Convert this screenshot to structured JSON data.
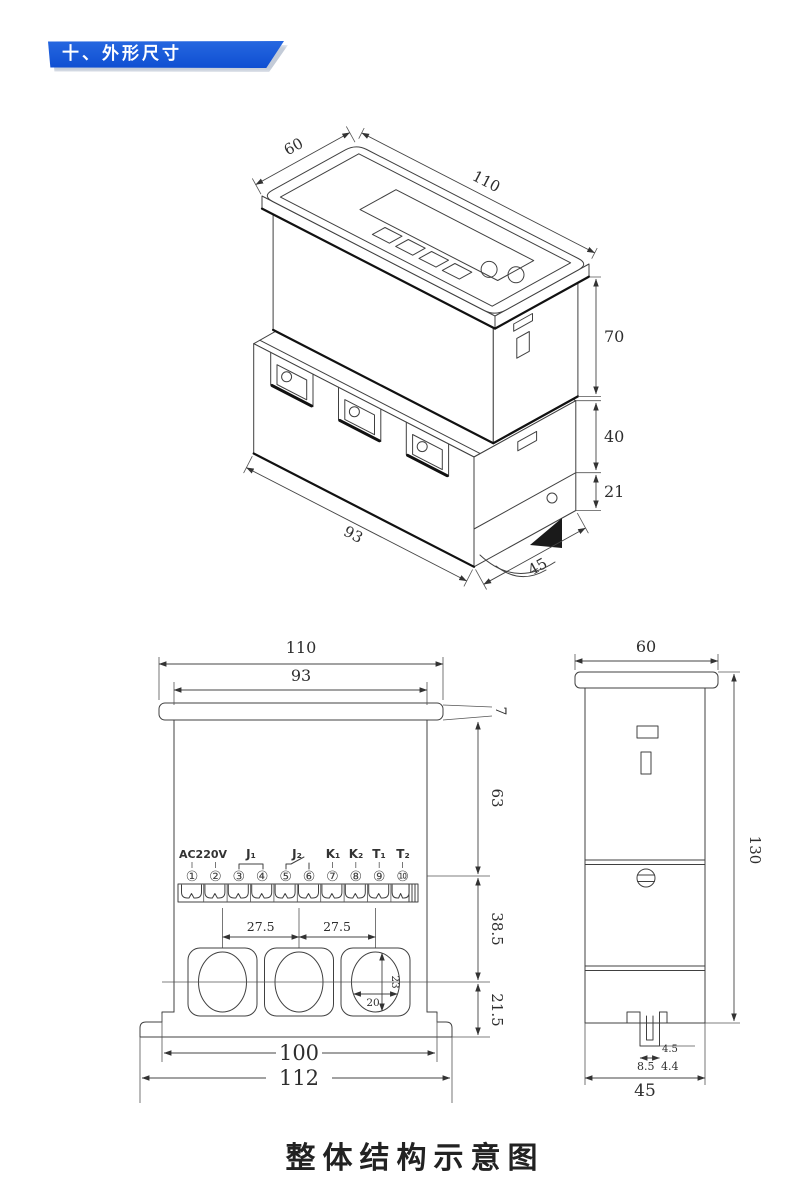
{
  "header": {
    "section_label": "十、外形尺寸"
  },
  "caption": "整体结构示意图",
  "colors": {
    "banner_blue": "#1557d3",
    "line": "#404040"
  },
  "iso_view": {
    "dims": {
      "top_depth": "60",
      "top_length": "110",
      "upper_height": "70",
      "mid_height": "40",
      "rail_height": "21",
      "base_length": "93",
      "base_depth": "45"
    }
  },
  "front_view": {
    "dims": {
      "cap_width": "110",
      "body_width": "93",
      "cap_thickness": "7",
      "h_top": "63",
      "h_mid": "38.5",
      "h_bottom": "21.5",
      "pitch_a": "27.5",
      "pitch_b": "27.5",
      "hole_w": "20",
      "hole_h": "23",
      "feet_span": "100",
      "overall_width": "112"
    },
    "terminal_labels": [
      "AC220V",
      "J₁",
      "J₂",
      "K₁",
      "K₂",
      "T₁",
      "T₂"
    ],
    "terminal_numbers": [
      "①",
      "②",
      "③",
      "④",
      "⑤",
      "⑥",
      "⑦",
      "⑧",
      "⑨",
      "⑩"
    ]
  },
  "side_view": {
    "dims": {
      "depth": "60",
      "height": "130",
      "bottom_depth": "45",
      "slot_depth": "4.5",
      "clip_w": "8.5",
      "clip_inner": "4.4"
    }
  }
}
